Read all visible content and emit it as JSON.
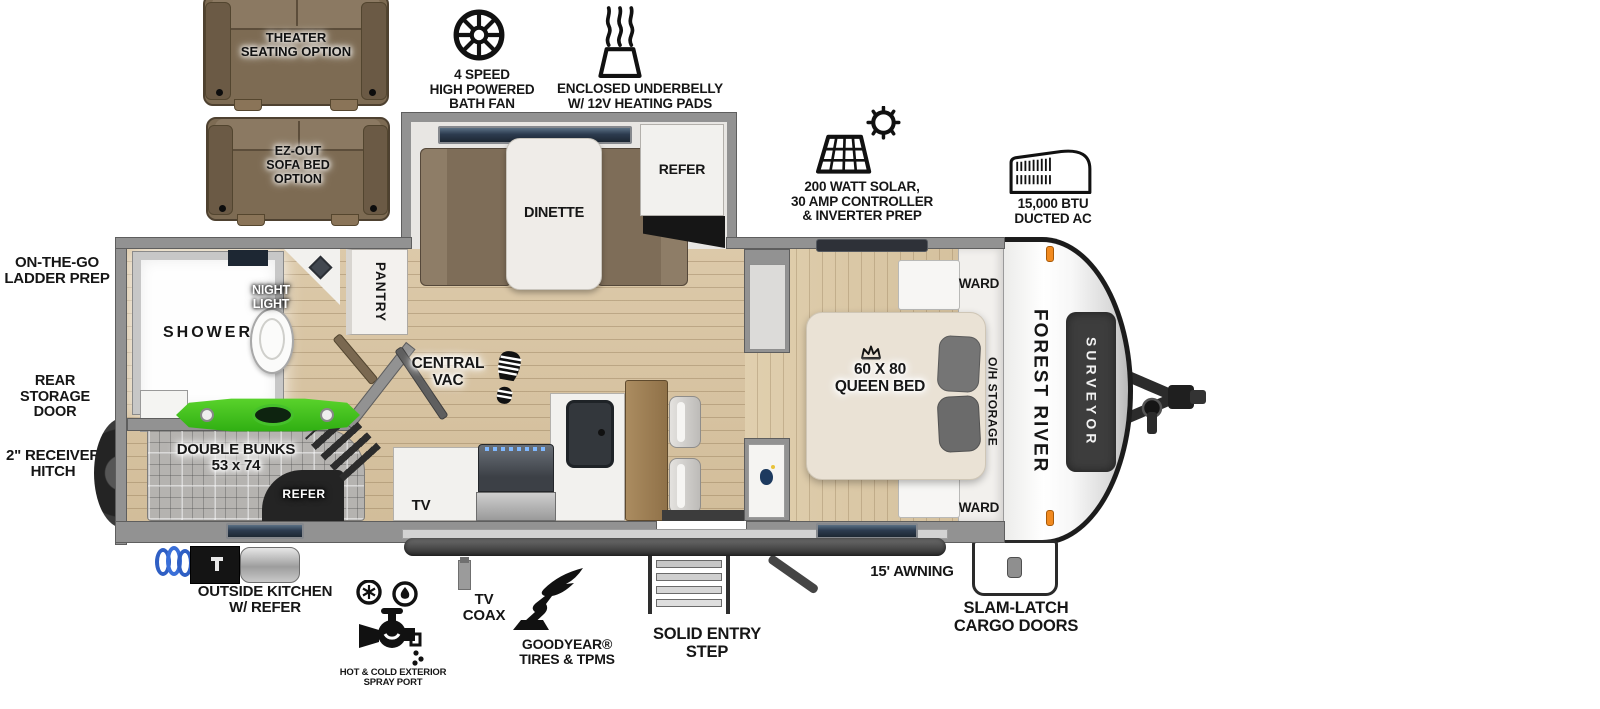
{
  "brand": {
    "maker": "FOREST RIVER",
    "model": "SURVEYOR"
  },
  "options": {
    "theater_seating": "THEATER\nSEATING OPTION",
    "sofa_bed": "EZ-OUT\nSOFA BED\nOPTION"
  },
  "exterior_callouts": {
    "bath_fan": {
      "icon": "fan-icon",
      "label": "4 SPEED\nHIGH POWERED\nBATH FAN"
    },
    "underbelly": {
      "icon": "heating-pads-icon",
      "label": "ENCLOSED UNDERBELLY\nW/ 12V HEATING PADS"
    },
    "solar": {
      "icon": "solar-panel-icon",
      "label": "200 WATT SOLAR,\n30 AMP CONTROLLER\n& INVERTER PREP"
    },
    "ac": {
      "icon": "ac-unit-icon",
      "label": "15,000 BTU\nDUCTED AC"
    },
    "ladder_prep": {
      "label": "ON-THE-GO\nLADDER PREP"
    },
    "rear_storage": {
      "label": "REAR STORAGE\nDOOR"
    },
    "receiver_hitch": {
      "label": "2\" RECEIVER\nHITCH"
    },
    "outside_kitchen": {
      "label": "OUTSIDE KITCHEN\nW/ REFER"
    },
    "spray_port": {
      "icon": "spray-port-icon",
      "label": "HOT & COLD EXTERIOR\nSPRAY PORT"
    },
    "tv_coax": {
      "label": "TV\nCOAX"
    },
    "goodyear": {
      "icon": "goodyear-wingfoot-icon",
      "label": "GOODYEAR®\nTIRES & TPMS"
    },
    "entry_step": {
      "label": "SOLID ENTRY\nSTEP"
    },
    "awning": {
      "label": "15' AWNING"
    },
    "cargo_doors": {
      "label": "SLAM-LATCH\nCARGO DOORS"
    }
  },
  "interior_labels": {
    "dinette": "DINETTE",
    "refer": "REFER",
    "shower": "SHOWER",
    "night_light": "NIGHT\nLIGHT",
    "pantry": "PANTRY",
    "central_vac": "CENTRAL\nVAC",
    "double_bunks": "DOUBLE BUNKS\n53 x 74",
    "bunk_refer": "REFER",
    "tv": "TV",
    "queen_bed": "60 X 80\nQUEEN BED",
    "ward_top": "WARD",
    "ward_bottom": "WARD",
    "oh_storage": "O/H STORAGE"
  },
  "icons": {
    "central_vac": "footprint-icon",
    "queen_bed": "crown-icon",
    "entry_door": "bear-decal"
  },
  "colors": {
    "wall": "#929292",
    "floor": "#d7c3a2",
    "kayak_green": "#3fc31d",
    "window_blue": "#2c3b4f",
    "brand_badge": "#3d3d3d",
    "marker_light": "#f18a20",
    "couch_brown": "#7d6b53"
  }
}
